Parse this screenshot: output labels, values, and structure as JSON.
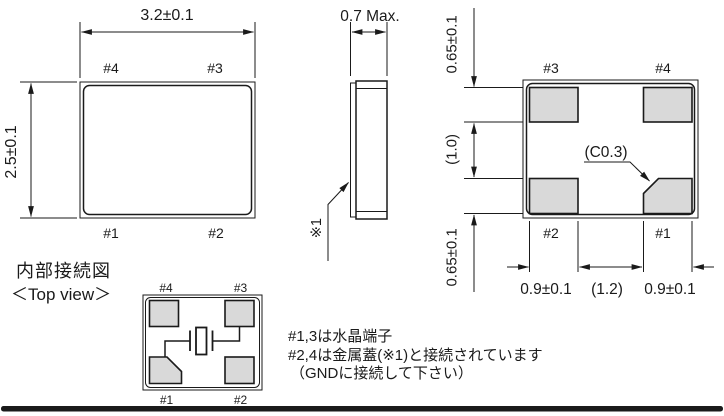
{
  "views": {
    "top_view": {
      "dim_width": "3.2±0.1",
      "dim_height": "2.5±0.1",
      "pad_labels": {
        "top_left": "#4",
        "top_right": "#3",
        "bottom_left": "#1",
        "bottom_right": "#2"
      }
    },
    "side_view": {
      "dim_thickness": "0.7 Max.",
      "lid_note": "※1"
    },
    "bottom_view": {
      "pad_labels": {
        "top_left": "#3",
        "top_right": "#4",
        "bottom_left": "#2",
        "bottom_right": "#1"
      },
      "chamfer_label": "(C0.3)",
      "dims_left": [
        "0.65±0.1",
        "(1.0)",
        "0.65±0.1"
      ],
      "dims_bottom": [
        "0.9±0.1",
        "(1.2)",
        "0.9±0.1"
      ]
    },
    "internal_view": {
      "title": "内部接続図",
      "subtitle": "＜Top view＞",
      "pad_labels": {
        "top_left": "#4",
        "top_right": "#3",
        "bottom_left": "#1",
        "bottom_right": "#2"
      }
    }
  },
  "notes": [
    "#1,3は水晶端子",
    "#2,4は金属蓋(※1)と接続されています",
    "（GNDに接続して下さい）"
  ],
  "colors": {
    "line": "#1a1a1a",
    "pad_fill": "#d9d9d9",
    "background": "#ffffff"
  }
}
